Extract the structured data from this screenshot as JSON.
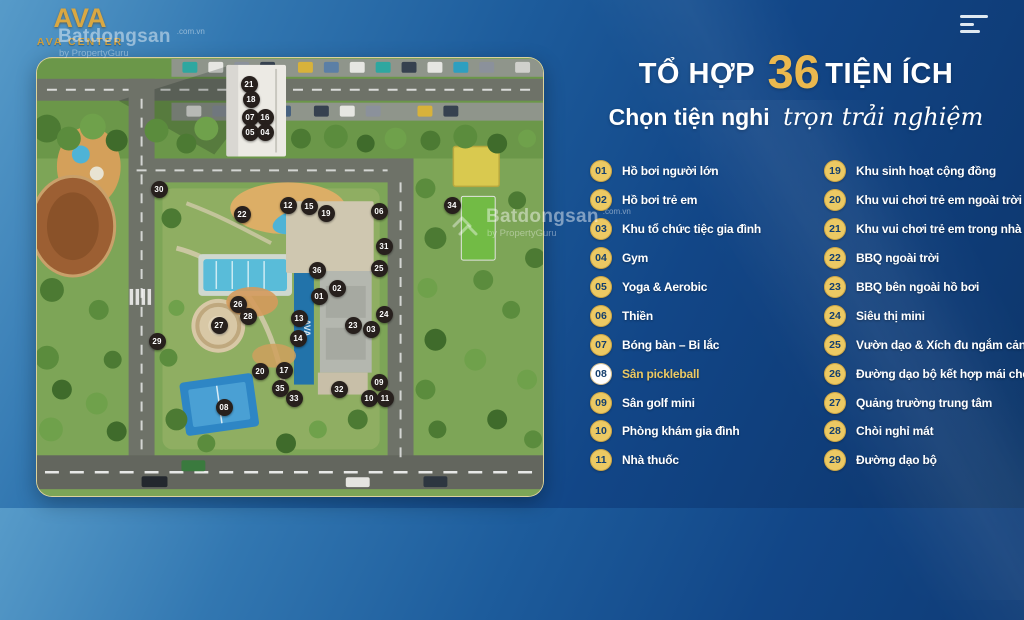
{
  "brand": {
    "logo_monogram": "AVA",
    "logo_name": "AVA CENTER"
  },
  "watermark": {
    "name": "Batdongsan",
    "domain": ".com.vn",
    "byline": "by PropertyGuru"
  },
  "header": {
    "title_prefix": "TỔ HỢP",
    "title_number": "36",
    "title_suffix": "TIỆN ÍCH",
    "subtitle_bold": "Chọn tiện nghi",
    "subtitle_script": "trọn trải nghiệm"
  },
  "colors": {
    "accent_gold": "#ecc963",
    "title_gold": "#eab84e",
    "bg_navy": "#0e3a74",
    "marker_dark": "#27201d",
    "legend_number_navy": "#143f6e"
  },
  "legend": {
    "columns": [
      {
        "items": [
          {
            "num": "01",
            "label": "Hồ bơi người lớn",
            "highlight": false
          },
          {
            "num": "02",
            "label": "Hồ bơi trẻ em",
            "highlight": false
          },
          {
            "num": "03",
            "label": "Khu tổ chức tiệc gia đình",
            "highlight": false
          },
          {
            "num": "04",
            "label": "Gym",
            "highlight": false
          },
          {
            "num": "05",
            "label": "Yoga & Aerobic",
            "highlight": false
          },
          {
            "num": "06",
            "label": "Thiền",
            "highlight": false
          },
          {
            "num": "07",
            "label": "Bóng bàn – Bi lắc",
            "highlight": false
          },
          {
            "num": "08",
            "label": "Sân pickleball",
            "highlight": true
          },
          {
            "num": "09",
            "label": "Sân golf mini",
            "highlight": false
          },
          {
            "num": "10",
            "label": "Phòng khám gia đình",
            "highlight": false
          },
          {
            "num": "11",
            "label": "Nhà thuốc",
            "highlight": false
          }
        ]
      },
      {
        "items": [
          {
            "num": "19",
            "label": "Khu sinh hoạt cộng đồng",
            "highlight": false
          },
          {
            "num": "20",
            "label": "Khu vui chơi trẻ em ngoài trời",
            "highlight": false
          },
          {
            "num": "21",
            "label": "Khu vui chơi trẻ em trong nhà",
            "highlight": false
          },
          {
            "num": "22",
            "label": "BBQ ngoài trời",
            "highlight": false
          },
          {
            "num": "23",
            "label": "BBQ bên ngoài hồ bơi",
            "highlight": false
          },
          {
            "num": "24",
            "label": "Siêu thị mini",
            "highlight": false
          },
          {
            "num": "25",
            "label": "Vườn dạo & Xích đu ngắm cảnh",
            "highlight": false
          },
          {
            "num": "26",
            "label": "Đường dạo bộ kết hợp mái che",
            "highlight": false
          },
          {
            "num": "27",
            "label": "Quảng trường trung tâm",
            "highlight": false
          },
          {
            "num": "28",
            "label": "Chòi nghỉ mát",
            "highlight": false
          },
          {
            "num": "29",
            "label": "Đường dạo bộ",
            "highlight": false
          }
        ]
      }
    ]
  },
  "map": {
    "pool_label": "AVA",
    "markers": [
      {
        "num": "21",
        "x": 212,
        "y": 26
      },
      {
        "num": "18",
        "x": 214,
        "y": 41
      },
      {
        "num": "07",
        "x": 213,
        "y": 59
      },
      {
        "num": "16",
        "x": 228,
        "y": 59
      },
      {
        "num": "05",
        "x": 213,
        "y": 74
      },
      {
        "num": "04",
        "x": 228,
        "y": 74
      },
      {
        "num": "30",
        "x": 122,
        "y": 131
      },
      {
        "num": "22",
        "x": 205,
        "y": 156
      },
      {
        "num": "12",
        "x": 251,
        "y": 147
      },
      {
        "num": "15",
        "x": 272,
        "y": 148
      },
      {
        "num": "19",
        "x": 289,
        "y": 155
      },
      {
        "num": "06",
        "x": 342,
        "y": 153
      },
      {
        "num": "34",
        "x": 415,
        "y": 147
      },
      {
        "num": "31",
        "x": 347,
        "y": 188
      },
      {
        "num": "25",
        "x": 342,
        "y": 210
      },
      {
        "num": "36",
        "x": 280,
        "y": 212
      },
      {
        "num": "02",
        "x": 300,
        "y": 230
      },
      {
        "num": "01",
        "x": 282,
        "y": 238
      },
      {
        "num": "13",
        "x": 262,
        "y": 260
      },
      {
        "num": "14",
        "x": 261,
        "y": 280
      },
      {
        "num": "26",
        "x": 201,
        "y": 246
      },
      {
        "num": "28",
        "x": 211,
        "y": 258
      },
      {
        "num": "27",
        "x": 182,
        "y": 267
      },
      {
        "num": "29",
        "x": 120,
        "y": 283
      },
      {
        "num": "24",
        "x": 347,
        "y": 256
      },
      {
        "num": "23",
        "x": 316,
        "y": 267
      },
      {
        "num": "03",
        "x": 334,
        "y": 271
      },
      {
        "num": "20",
        "x": 223,
        "y": 313
      },
      {
        "num": "17",
        "x": 247,
        "y": 312
      },
      {
        "num": "35",
        "x": 243,
        "y": 330
      },
      {
        "num": "33",
        "x": 257,
        "y": 340
      },
      {
        "num": "08",
        "x": 187,
        "y": 349
      },
      {
        "num": "32",
        "x": 302,
        "y": 331
      },
      {
        "num": "09",
        "x": 342,
        "y": 324
      },
      {
        "num": "10",
        "x": 332,
        "y": 340
      },
      {
        "num": "11",
        "x": 348,
        "y": 340
      }
    ]
  }
}
